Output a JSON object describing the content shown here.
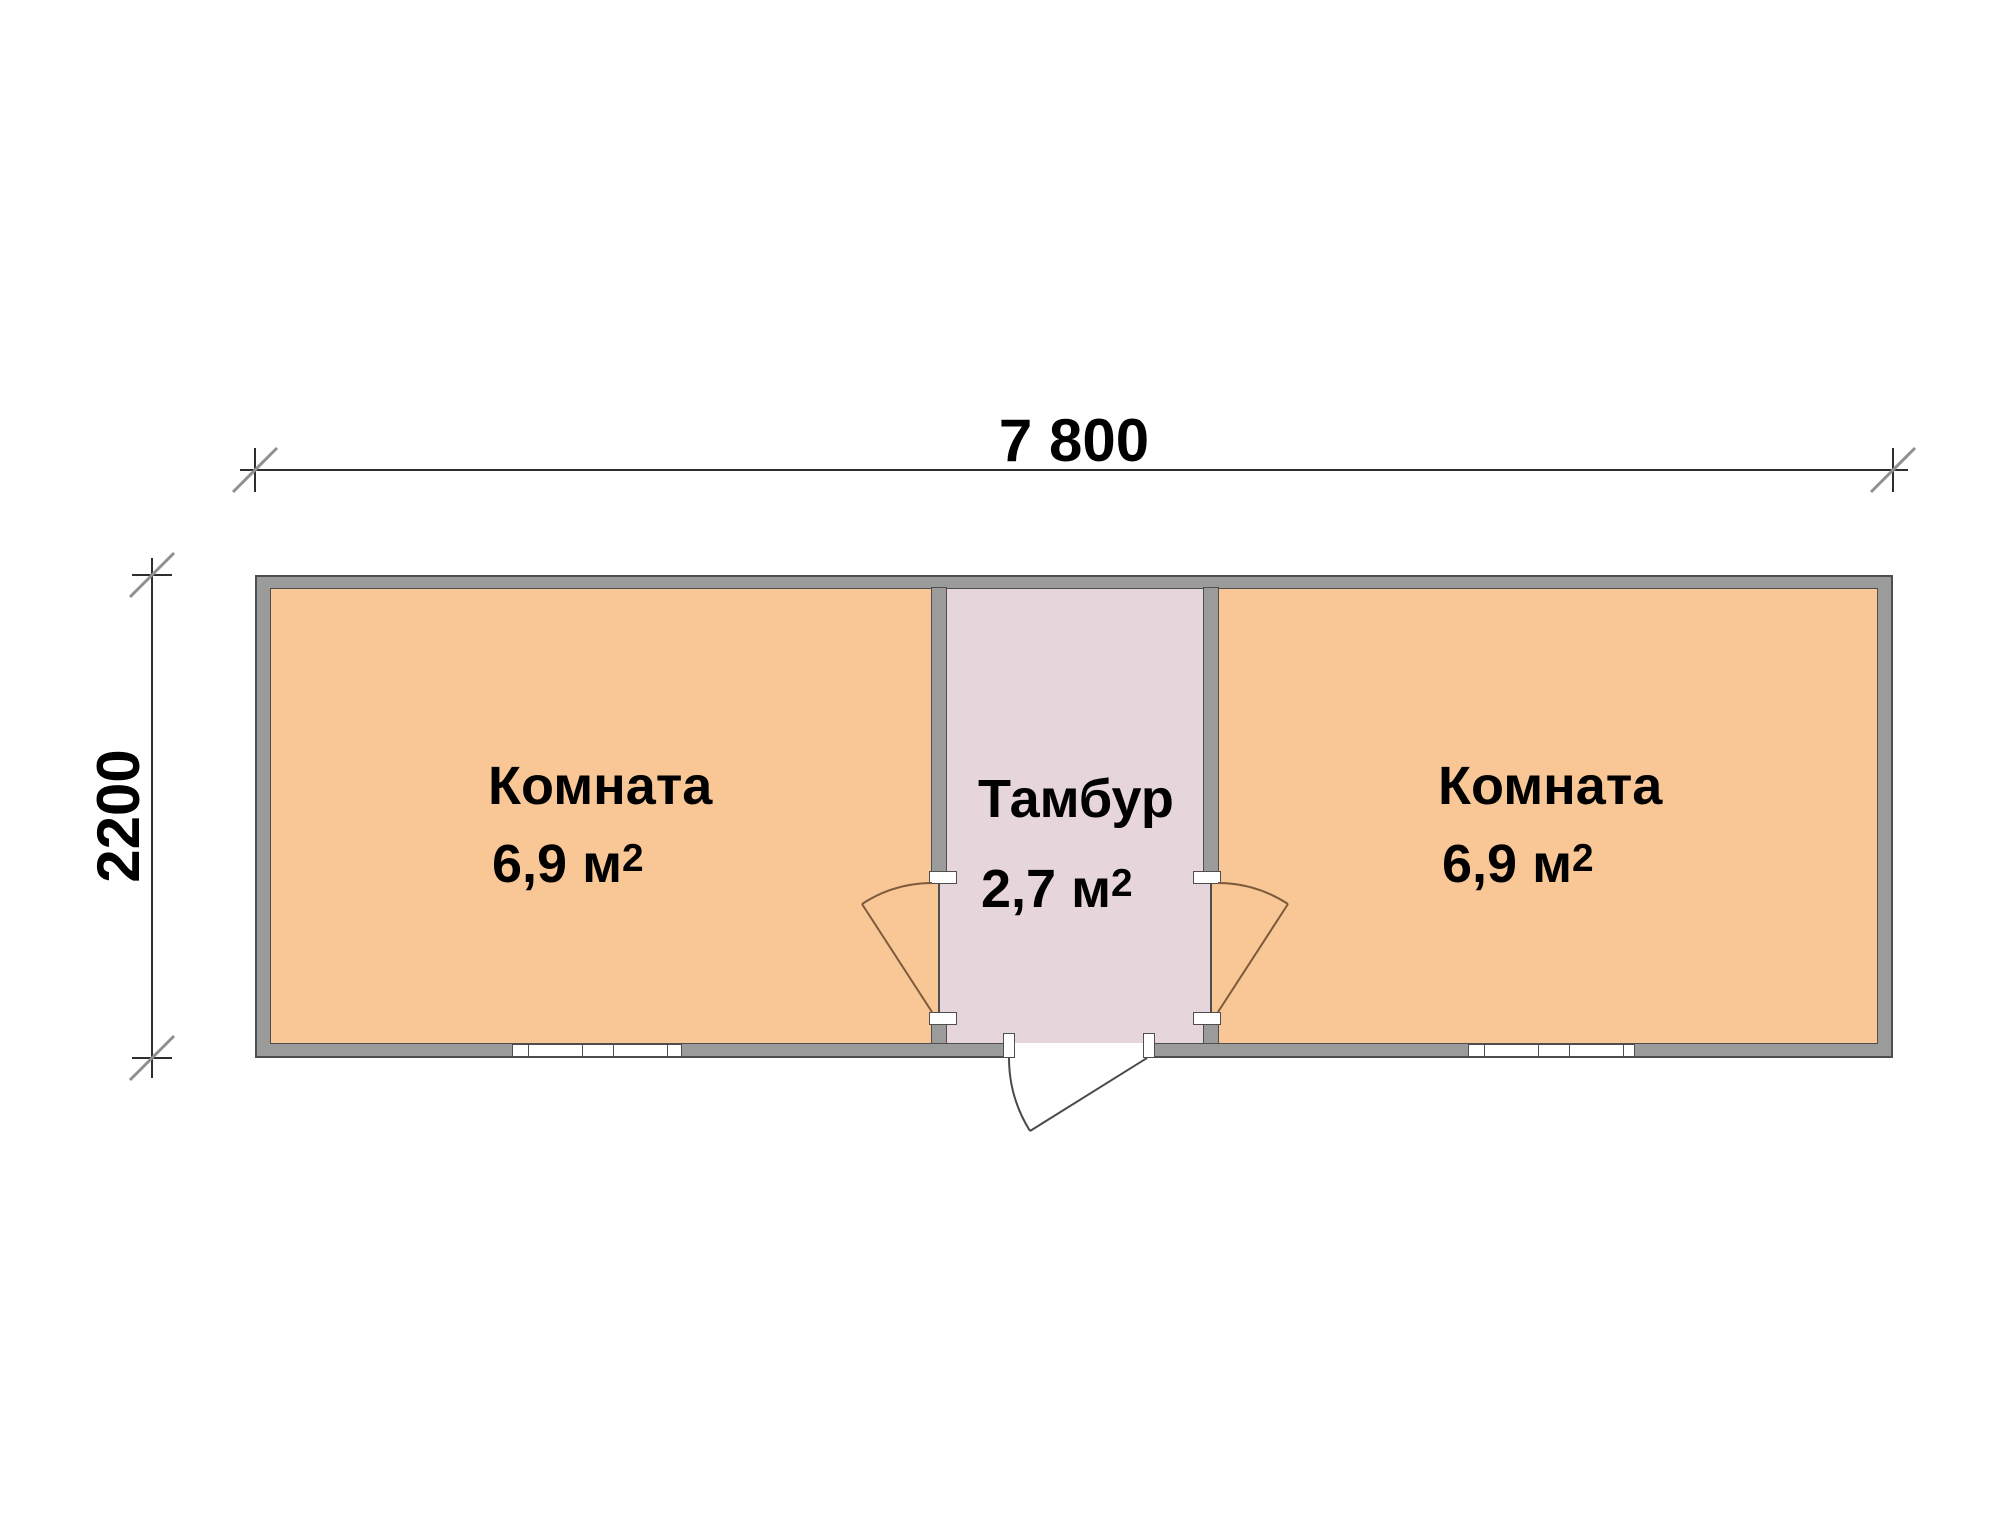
{
  "plan": {
    "type": "floor-plan",
    "dimensions": {
      "width_label": "7 800",
      "height_label": "2200"
    },
    "rooms": [
      {
        "name": "Комната",
        "area_label": "6,9 м",
        "area_sup": "2"
      },
      {
        "name": "Тамбур",
        "area_label": "2,7 м",
        "area_sup": "2"
      },
      {
        "name": "Комната",
        "area_label": "6,9 м",
        "area_sup": "2"
      }
    ],
    "features": {
      "windows": 2,
      "interior_doors": 2,
      "exterior_doors": 1
    },
    "colors": {
      "room_fill": "#F9C795",
      "vestibule_fill": "#E6D5DB",
      "wall_fill": "#9B9B9B",
      "wall_outline": "#4E4E4E",
      "interior_door_line": "#7C5A3C",
      "exterior_door_line": "#4A4A4A",
      "dimension_line": "#2E2E2E",
      "tick_mark": "#909090",
      "text": "#000000",
      "background": "#FFFFFF"
    }
  }
}
